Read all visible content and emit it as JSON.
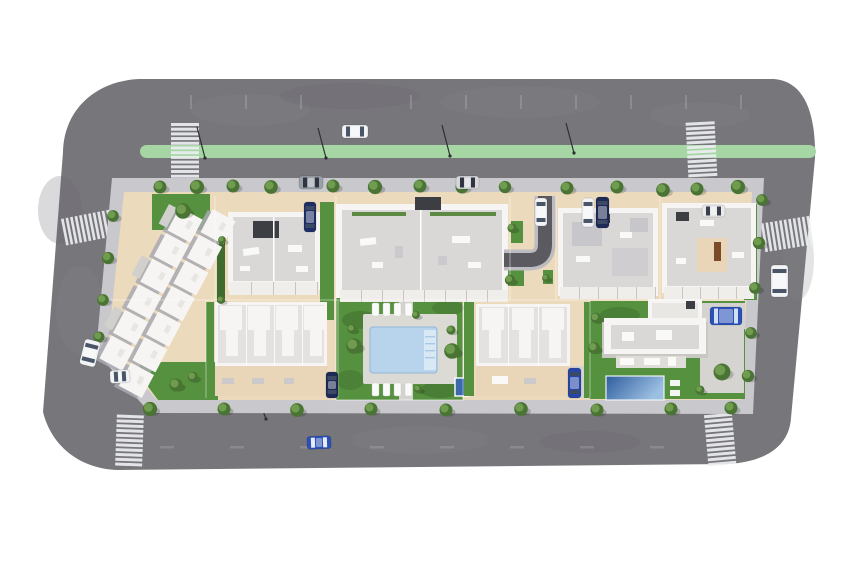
{
  "scene": {
    "type": "aerial-3d-render",
    "description": "Top-down architectural rendering of a residential development block surrounded by a gray ring road with a green bike lane, zebra crosswalks, street trees, parked cars, white apartment buildings and townhouses, a communal pool garden and a private villa with pool",
    "background": "white"
  },
  "palette": {
    "road": "#77767b",
    "curb": "#bdbcc0",
    "driveway": "#5b5a60",
    "sidewalk": "#c9c8cc",
    "ground": "#ecdabc",
    "terrace": "#e9d6b8",
    "lawn": "#55913e",
    "lawn_dark": "#3f6b2e",
    "hedge": "#5c8a44",
    "bike_lane": "#a5d6a4",
    "building_white": "#f6f5f3",
    "roof_gray": "#dad8d6",
    "roof_dark": "#3d3d44",
    "pool_water": "#b7d4ec",
    "pool_steps": "#d9e8f5",
    "villa_pool_deep": "#2e5d9e",
    "villa_pool_shallow": "#9cc0e2",
    "crosswalk": "#eceef0",
    "tree_dark": "#4a7434",
    "tree_light": "#6f9c4e",
    "car_blue": "#2b50b8",
    "car_navy": "#1d2a55",
    "car_white": "#f2f3f5",
    "car_gray": "#9aa0a8"
  },
  "road": {
    "bike_lane": {
      "x": 140,
      "y": 145,
      "w": 676,
      "h": 13
    },
    "crosswalks": [
      {
        "x": 171,
        "y": 123,
        "count": 12,
        "step": 4.7,
        "len": 28,
        "bar": 3,
        "type": "h",
        "rot": 0,
        "cx": 185,
        "cy": 150
      },
      {
        "x": 687,
        "y": 122,
        "count": 12,
        "step": 4.7,
        "len": 29,
        "bar": 3,
        "type": "h",
        "rot": -3,
        "cx": 701,
        "cy": 150
      },
      {
        "x": 63,
        "y": 214,
        "count": 11,
        "step": 4.6,
        "len": 27,
        "bar": 2.7,
        "type": "v",
        "rot": -11,
        "cx": 88,
        "cy": 227
      },
      {
        "x": 763,
        "y": 221,
        "count": 11,
        "step": 4.6,
        "len": 29,
        "bar": 2.7,
        "type": "v",
        "rot": -9,
        "cx": 778,
        "cy": 236
      },
      {
        "x": 116,
        "y": 415,
        "count": 11,
        "step": 4.8,
        "len": 27,
        "bar": 3,
        "type": "h",
        "rot": 2,
        "cx": 130,
        "cy": 440
      },
      {
        "x": 706,
        "y": 414,
        "count": 11,
        "step": 4.8,
        "len": 28,
        "bar": 3,
        "type": "h",
        "rot": -5,
        "cx": 720,
        "cy": 438
      }
    ],
    "lane_ticks_top": {
      "y": 95,
      "xs": [
        190,
        245,
        300,
        410,
        465,
        520,
        575,
        630,
        685,
        740
      ]
    },
    "lane_ticks_bottom": {
      "y": 446,
      "xs": [
        160,
        230,
        300,
        370,
        440,
        510,
        580,
        650
      ]
    },
    "street_lamps": [
      [
        197,
        127,
        205,
        158
      ],
      [
        318,
        128,
        326,
        158
      ],
      [
        442,
        125,
        450,
        156
      ],
      [
        566,
        123,
        574,
        153
      ],
      [
        260,
        403,
        266,
        419
      ]
    ]
  },
  "buildings": {
    "townhouse_cluster_west": {
      "origin": [
        196,
        198
      ],
      "rot": 118,
      "size": 26,
      "rows": [
        {
          "y": -46,
          "xs": [
            2,
            31,
            60,
            89,
            118,
            147,
            176
          ]
        },
        {
          "y": -16,
          "xs": [
            16,
            45,
            74,
            103,
            132,
            161
          ]
        }
      ]
    },
    "terrace_rows": [
      {
        "x": 340,
        "y": 290,
        "w": 168,
        "h": 12,
        "step": 21
      },
      {
        "x": 560,
        "y": 287,
        "w": 96,
        "h": 12,
        "step": 19
      },
      {
        "x": 664,
        "y": 287,
        "w": 90,
        "h": 12,
        "step": 18
      },
      {
        "x": 229,
        "y": 282,
        "w": 90,
        "h": 13,
        "step": 22
      }
    ],
    "plot_lines": {
      "verticals_top": [
        215,
        336,
        510,
        556,
        660
      ],
      "verticals_bottom": [
        206,
        338,
        463,
        590
      ],
      "horizontal_y": 300
    }
  },
  "amenities": {
    "communal_pool": {
      "x": 370,
      "y": 327,
      "w": 67,
      "h": 46,
      "steps_side": "right"
    },
    "villa_pool": {
      "x": 606,
      "y": 376,
      "w": 58,
      "h": 24
    },
    "jacuzzi": {
      "x": 455,
      "y": 378,
      "w": 14,
      "h": 18
    },
    "sun_loungers": [
      [
        372,
        303
      ],
      [
        383,
        303
      ],
      [
        394,
        303
      ],
      [
        405,
        303
      ],
      [
        372,
        383
      ],
      [
        383,
        383
      ],
      [
        394,
        383
      ],
      [
        405,
        383
      ]
    ]
  },
  "landscape": {
    "trees": [
      [
        160,
        187,
        1
      ],
      [
        197,
        187,
        1.1
      ],
      [
        233,
        186,
        1
      ],
      [
        271,
        187,
        1.05
      ],
      [
        333,
        186,
        1
      ],
      [
        375,
        187,
        1.1
      ],
      [
        420,
        186,
        1
      ],
      [
        462,
        187,
        1
      ],
      [
        505,
        187,
        0.95
      ],
      [
        567,
        188,
        1
      ],
      [
        617,
        187,
        1
      ],
      [
        663,
        190,
        1.05
      ],
      [
        697,
        189,
        1
      ],
      [
        738,
        187,
        1.1
      ],
      [
        150,
        409,
        1.1
      ],
      [
        224,
        409,
        1
      ],
      [
        297,
        410,
        1.05
      ],
      [
        371,
        409,
        1
      ],
      [
        446,
        410,
        1
      ],
      [
        521,
        409,
        1.05
      ],
      [
        597,
        410,
        1
      ],
      [
        671,
        409,
        1
      ],
      [
        731,
        408,
        1
      ],
      [
        113,
        216,
        0.9
      ],
      [
        108,
        258,
        0.95
      ],
      [
        103,
        300,
        0.9
      ],
      [
        99,
        337,
        0.85
      ],
      [
        762,
        200,
        0.9
      ],
      [
        759,
        243,
        0.95
      ],
      [
        755,
        288,
        0.9
      ],
      [
        751,
        333,
        0.9
      ],
      [
        748,
        376,
        0.95
      ],
      [
        183,
        211,
        1.2
      ],
      [
        176,
        385,
        1
      ],
      [
        193,
        377,
        0.8
      ],
      [
        354,
        346,
        1.2
      ],
      [
        452,
        351,
        1.2
      ],
      [
        352,
        329,
        0.7
      ],
      [
        451,
        330,
        0.7
      ],
      [
        416,
        315,
        0.6
      ],
      [
        418,
        389,
        0.6
      ],
      [
        596,
        318,
        0.8
      ],
      [
        594,
        348,
        0.9
      ],
      [
        722,
        372,
        1.3
      ],
      [
        700,
        390,
        0.7
      ],
      [
        512,
        228,
        0.7
      ],
      [
        510,
        280,
        0.8
      ],
      [
        546,
        278,
        0.6
      ],
      [
        222,
        240,
        0.6
      ],
      [
        221,
        300,
        0.6
      ]
    ]
  },
  "vehicles": {
    "cars": [
      {
        "x": 342,
        "y": 125,
        "w": 26,
        "h": 13,
        "rot": 0,
        "body": "#f2f3f5",
        "glass": "#4a5568",
        "loc": "top-road"
      },
      {
        "x": 771,
        "y": 265,
        "w": 17,
        "h": 32,
        "rot": 0,
        "body": "#f2f3f5",
        "glass": "#4a5568",
        "loc": "right-road"
      },
      {
        "x": 307,
        "y": 436,
        "w": 24,
        "h": 13,
        "rot": -2,
        "body": "#2b50b8",
        "glass": "#e8ecf2",
        "loc": "bottom-road"
      },
      {
        "x": 82,
        "y": 340,
        "w": 16,
        "h": 26,
        "rot": 14,
        "body": "#f2f3f5",
        "glass": "#4a5568",
        "loc": "left-road"
      },
      {
        "x": 299,
        "y": 176,
        "w": 24,
        "h": 13,
        "rot": 0,
        "body": "#9aa0a8",
        "glass": "#2e3440",
        "loc": "top-parking"
      },
      {
        "x": 456,
        "y": 176,
        "w": 23,
        "h": 13,
        "rot": 0,
        "body": "#d4d6da",
        "glass": "#2e3440",
        "loc": "top-parking"
      },
      {
        "x": 702,
        "y": 205,
        "w": 23,
        "h": 12,
        "rot": 0,
        "body": "#e8e9ec",
        "glass": "#3a3f4a",
        "loc": "ne-driveway"
      },
      {
        "x": 535,
        "y": 198,
        "w": 12,
        "h": 28,
        "rot": 0,
        "body": "#f2f3f5",
        "glass": "#4a5568",
        "loc": "center-driveway"
      },
      {
        "x": 582,
        "y": 198,
        "w": 12,
        "h": 29,
        "rot": 0,
        "body": "#f2f3f5",
        "glass": "#4a5568",
        "loc": "ne-parking"
      },
      {
        "x": 596,
        "y": 197,
        "w": 13,
        "h": 31,
        "rot": 0,
        "body": "#1d2a55",
        "glass": "#3d4a66",
        "loc": "ne-parking"
      },
      {
        "x": 304,
        "y": 202,
        "w": 12,
        "h": 30,
        "rot": 0,
        "body": "#1f2f66",
        "glass": "#3d4a66",
        "loc": "nw-parking"
      },
      {
        "x": 326,
        "y": 372,
        "w": 12,
        "h": 26,
        "rot": 0,
        "body": "#1d2a55",
        "glass": "#3d4a66",
        "loc": "sw-rowhouses"
      },
      {
        "x": 568,
        "y": 368,
        "w": 13,
        "h": 30,
        "rot": 0,
        "body": "#2446a8",
        "glass": "#3d4a66",
        "loc": "s-rowhouses"
      },
      {
        "x": 710,
        "y": 307,
        "w": 32,
        "h": 18,
        "rot": 0,
        "body": "#2b50b8",
        "glass": "#cfe0f0",
        "loc": "villa-pad"
      },
      {
        "x": 110,
        "y": 370,
        "w": 20,
        "h": 13,
        "rot": -3,
        "body": "#f2f3f5",
        "glass": "#4a5568",
        "loc": "sw-corner"
      }
    ]
  }
}
